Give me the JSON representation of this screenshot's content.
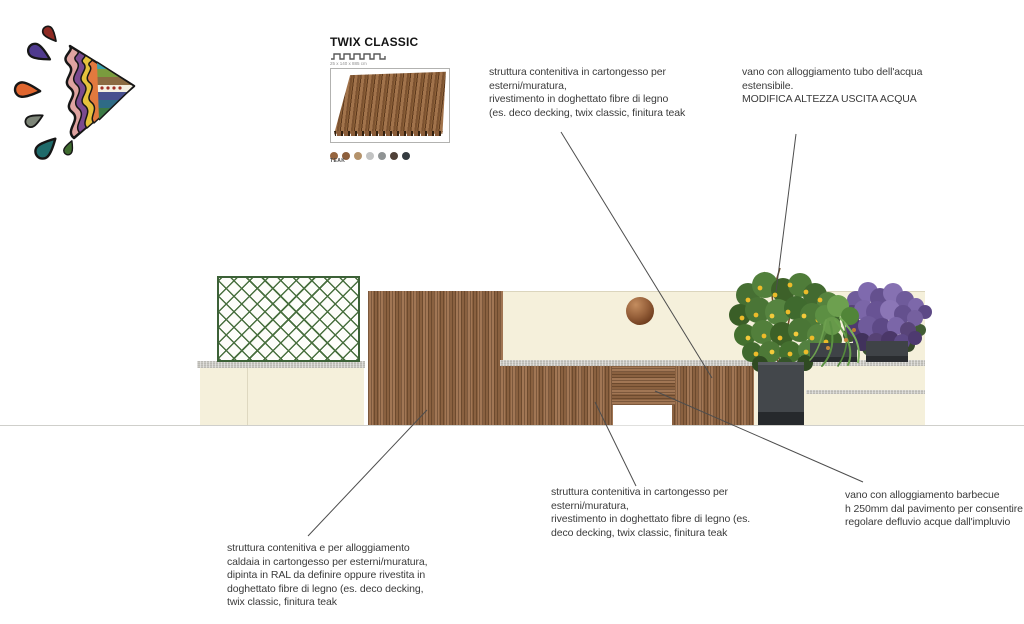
{
  "logo": {
    "name": "colorful-splash-triangle-logo"
  },
  "swatch": {
    "title": "TWIX CLASSIC",
    "dimensions": "25 x 140 x 885 cm",
    "finish_label": "TEAK",
    "colors": [
      "#96653f",
      "#8d5f3c",
      "#b4926a",
      "#c2c3c3",
      "#8f9394",
      "#4f4138",
      "#343b40"
    ]
  },
  "annotations": {
    "top_center": "struttura contenitiva in cartongesso per\nesterni/muratura,\nrivestimento in doghettato fibre di legno\n(es. deco decking, twix classic, finitura teak",
    "top_right": "vano con alloggiamento tubo dell'acqua\nestensibile.\nMODIFICA ALTEZZA USCITA ACQUA",
    "bottom_left": "struttura contenitiva e per alloggiamento\ncaldaia in cartongesso per esterni/muratura,\ndipinta in RAL da definire oppure rivestita in\ndoghettato fibre di legno (es. deco decking,\ntwix classic, finitura teak",
    "bottom_center": "struttura contenitiva in cartongesso per\nesterni/muratura,\nrivestimento in doghettato fibre di legno (es.\ndeco decking, twix classic, finitura teak",
    "bottom_right": "vano con alloggiamento barbecue\nh 250mm dal pavimento per consentire\nregolare defluvio acque dall'impluvio"
  },
  "palette": {
    "wall_cream": "#f5f0db",
    "wood_brown": "#9a6c47",
    "trellis_green": "#49703f",
    "planter_dark": "#43474b",
    "leader_line": "#4d4d4d"
  }
}
